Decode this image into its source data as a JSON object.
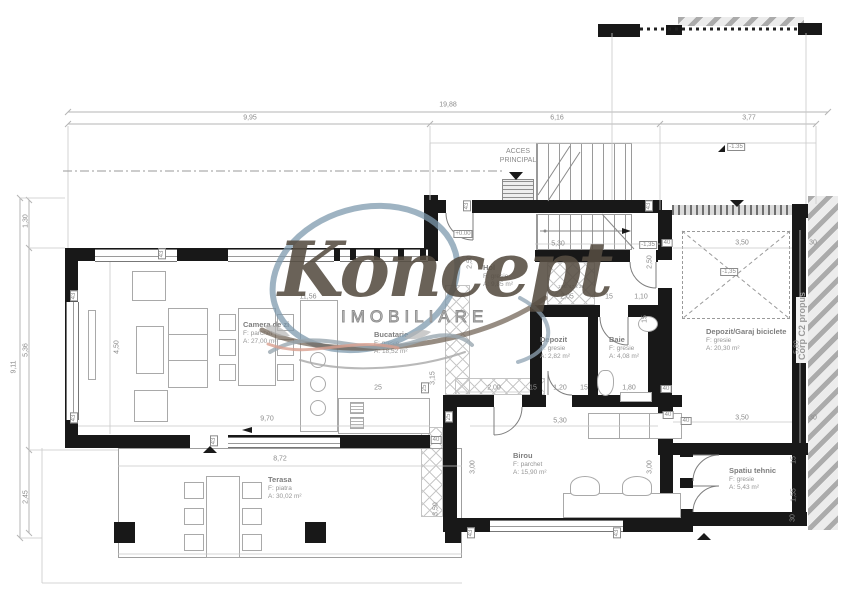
{
  "plan": {
    "type": "floor-plan",
    "watermark": {
      "script": "Koncept",
      "caps": "IMOBILIARE",
      "colors": {
        "script": "#564d42",
        "swirl_blue": "#7e99ad",
        "swirl_brown": "#6b5c4e",
        "swirl_salmon": "#d9a090"
      }
    },
    "annotations": {
      "acces_line1": "ACCES",
      "acces_line2": "PRINCIPAL",
      "corp": "Corp C2 propus",
      "stair_note": "18 tr. 17 x 28"
    },
    "colors": {
      "wall": "#181818",
      "line": "#b5b5b5",
      "text": "#8b8b8b"
    }
  },
  "rooms": [
    {
      "name": "Camera de zi",
      "floor": "F: parchet",
      "area": "A: 27,00 m²",
      "x": 243,
      "y": 320
    },
    {
      "name": "Bucatarie",
      "floor": "F: gresie",
      "area": "A: 18,52 m²",
      "x": 374,
      "y": 330
    },
    {
      "name": "Hol",
      "floor": "F: gresie",
      "area": "A: 9,85 m²",
      "x": 483,
      "y": 263
    },
    {
      "name": "Depozit",
      "floor": "F: gresie",
      "area": "A: 2,82 m²",
      "x": 540,
      "y": 335
    },
    {
      "name": "Baie",
      "floor": "F: gresie",
      "area": "A: 4,08 m²",
      "x": 609,
      "y": 335
    },
    {
      "name": "Depozit/Garaj biciclete",
      "floor": "F: gresie",
      "area": "A: 20,30 m²",
      "x": 706,
      "y": 327
    },
    {
      "name": "Birou",
      "floor": "F: parchet",
      "area": "A: 15,90 m²",
      "x": 513,
      "y": 451
    },
    {
      "name": "Spatiu tehnic",
      "floor": "F: gresie",
      "area": "A: 5,43 m²",
      "x": 729,
      "y": 466
    },
    {
      "name": "Terasa",
      "floor": "F: piatra",
      "area": "A: 30,02 m²",
      "x": 268,
      "y": 475
    }
  ],
  "dims": [
    {
      "t": "19,88",
      "x": 448,
      "y": 105
    },
    {
      "t": "9,95",
      "x": 250,
      "y": 118
    },
    {
      "t": "6,16",
      "x": 557,
      "y": 118
    },
    {
      "t": "3,77",
      "x": 749,
      "y": 118
    },
    {
      "t": "9,11",
      "x": 14,
      "y": 367,
      "r": 1
    },
    {
      "t": "1,30",
      "x": 26,
      "y": 221,
      "r": 1
    },
    {
      "t": "5,36",
      "x": 26,
      "y": 350,
      "r": 1
    },
    {
      "t": "2,45",
      "x": 26,
      "y": 497,
      "r": 1
    },
    {
      "t": "4,50",
      "x": 117,
      "y": 347,
      "r": 1
    },
    {
      "t": "9,70",
      "x": 267,
      "y": 419
    },
    {
      "t": "11,56",
      "x": 308,
      "y": 297
    },
    {
      "t": "8,72",
      "x": 280,
      "y": 459
    },
    {
      "t": "3,15",
      "x": 433,
      "y": 378,
      "r": 1
    },
    {
      "t": "5,30",
      "x": 558,
      "y": 244
    },
    {
      "t": "2,50",
      "x": 470,
      "y": 262,
      "r": 1
    },
    {
      "t": "2,50",
      "x": 650,
      "y": 262,
      "r": 1
    },
    {
      "t": "2,05",
      "x": 567,
      "y": 297
    },
    {
      "t": "15",
      "x": 609,
      "y": 297
    },
    {
      "t": "1,10",
      "x": 641,
      "y": 297
    },
    {
      "t": "5,30",
      "x": 560,
      "y": 421
    },
    {
      "t": "3,00",
      "x": 473,
      "y": 467,
      "r": 1
    },
    {
      "t": "3,00",
      "x": 650,
      "y": 467,
      "r": 1
    },
    {
      "t": "3,50",
      "x": 436,
      "y": 509,
      "r": 1
    },
    {
      "t": "3,50",
      "x": 742,
      "y": 243
    },
    {
      "t": "3,50",
      "x": 742,
      "y": 418
    },
    {
      "t": "5,80",
      "x": 797,
      "y": 347,
      "r": 1
    },
    {
      "t": "30",
      "x": 813,
      "y": 243
    },
    {
      "t": "30",
      "x": 813,
      "y": 418
    },
    {
      "t": "2,00",
      "x": 494,
      "y": 388
    },
    {
      "t": "25",
      "x": 378,
      "y": 388
    },
    {
      "t": "15",
      "x": 533,
      "y": 388
    },
    {
      "t": "1,20",
      "x": 560,
      "y": 388
    },
    {
      "t": "15",
      "x": 584,
      "y": 388
    },
    {
      "t": "1,80",
      "x": 629,
      "y": 388
    },
    {
      "t": "15",
      "x": 645,
      "y": 319,
      "r": 1
    },
    {
      "t": "15",
      "x": 794,
      "y": 460,
      "r": 1
    },
    {
      "t": "1,55",
      "x": 794,
      "y": 495,
      "r": 1
    },
    {
      "t": "30",
      "x": 793,
      "y": 518,
      "r": 1
    },
    {
      "t": "+0.00",
      "x": 463,
      "y": 234,
      "b": 1
    },
    {
      "t": "-1.35",
      "x": 736,
      "y": 147,
      "b": 1
    },
    {
      "t": "-1,35",
      "x": 648,
      "y": 245,
      "b": 1
    },
    {
      "t": "-1,35",
      "x": 729,
      "y": 272,
      "b": 1
    },
    {
      "t": "43",
      "x": 74,
      "y": 296,
      "r": 1,
      "b": 1
    },
    {
      "t": "43",
      "x": 74,
      "y": 418,
      "r": 1,
      "b": 1
    },
    {
      "t": "43",
      "x": 162,
      "y": 254,
      "r": 1,
      "b": 1
    },
    {
      "t": "43",
      "x": 214,
      "y": 441,
      "r": 1,
      "b": 1
    },
    {
      "t": "43",
      "x": 467,
      "y": 206,
      "r": 1,
      "b": 1
    },
    {
      "t": "43",
      "x": 649,
      "y": 206,
      "r": 1,
      "b": 1
    },
    {
      "t": "40",
      "x": 667,
      "y": 243,
      "b": 1
    },
    {
      "t": "40",
      "x": 666,
      "y": 389,
      "b": 1
    },
    {
      "t": "40",
      "x": 668,
      "y": 415,
      "b": 1
    },
    {
      "t": "40",
      "x": 436,
      "y": 440,
      "b": 1
    },
    {
      "t": "25",
      "x": 449,
      "y": 417,
      "r": 1,
      "b": 1
    },
    {
      "t": "40",
      "x": 686,
      "y": 421,
      "b": 1
    },
    {
      "t": "43",
      "x": 471,
      "y": 533,
      "r": 1,
      "b": 1
    },
    {
      "t": "43",
      "x": 617,
      "y": 533,
      "r": 1,
      "b": 1
    },
    {
      "t": "25",
      "x": 425,
      "y": 388,
      "r": 1,
      "b": 1
    }
  ]
}
